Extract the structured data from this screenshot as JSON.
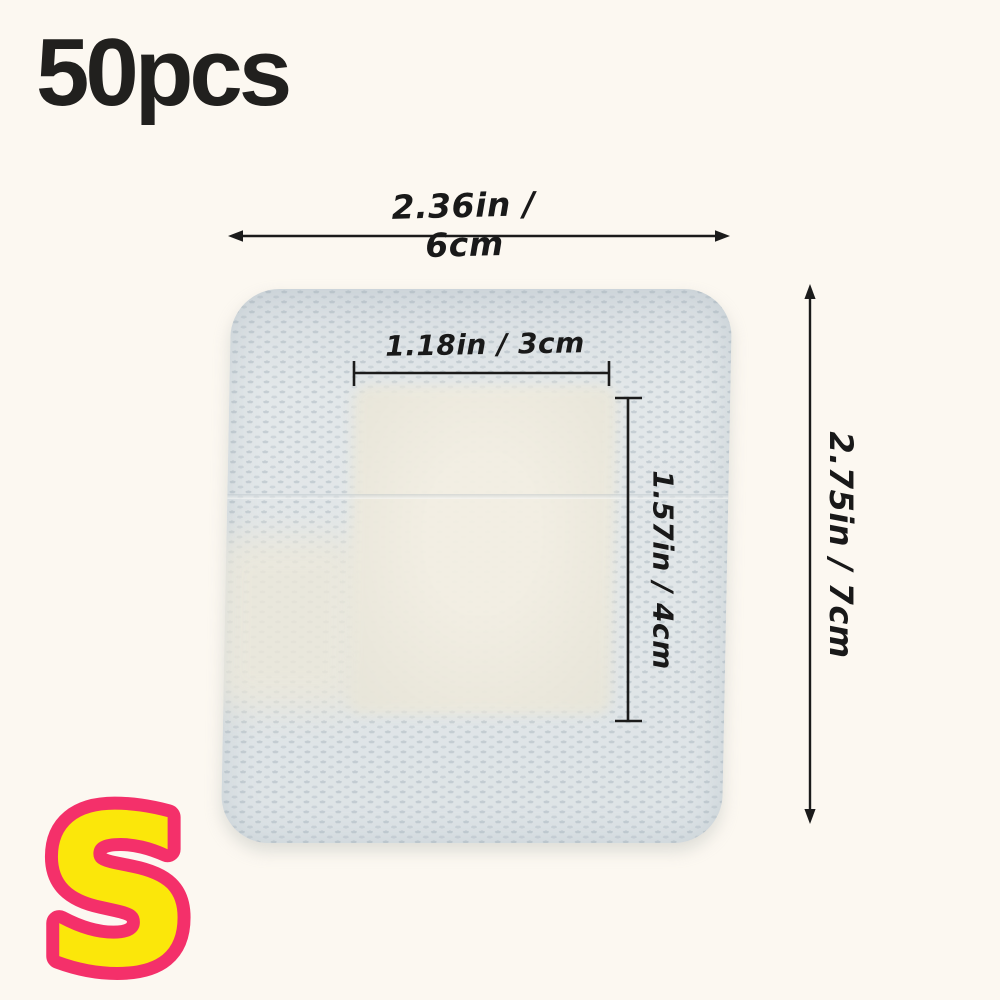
{
  "product_image": {
    "quantity_label": "50pcs",
    "size_badge": {
      "letter": "S",
      "fill_color": "#fbe70a",
      "outline_color": "#f4306a"
    },
    "dimensions": {
      "outer_width": "2.36in / 6cm",
      "outer_height": "2.75in / 7cm",
      "pad_width": "1.18in / 3cm",
      "pad_height": "1.57in / 4cm"
    },
    "colors": {
      "background": "#fcf8f1",
      "dressing_fabric": "#e0e5e7",
      "dressing_pad": "#f1ede1",
      "dimension_lines": "#1b1b1b",
      "quantity_text": "#21201e"
    }
  }
}
